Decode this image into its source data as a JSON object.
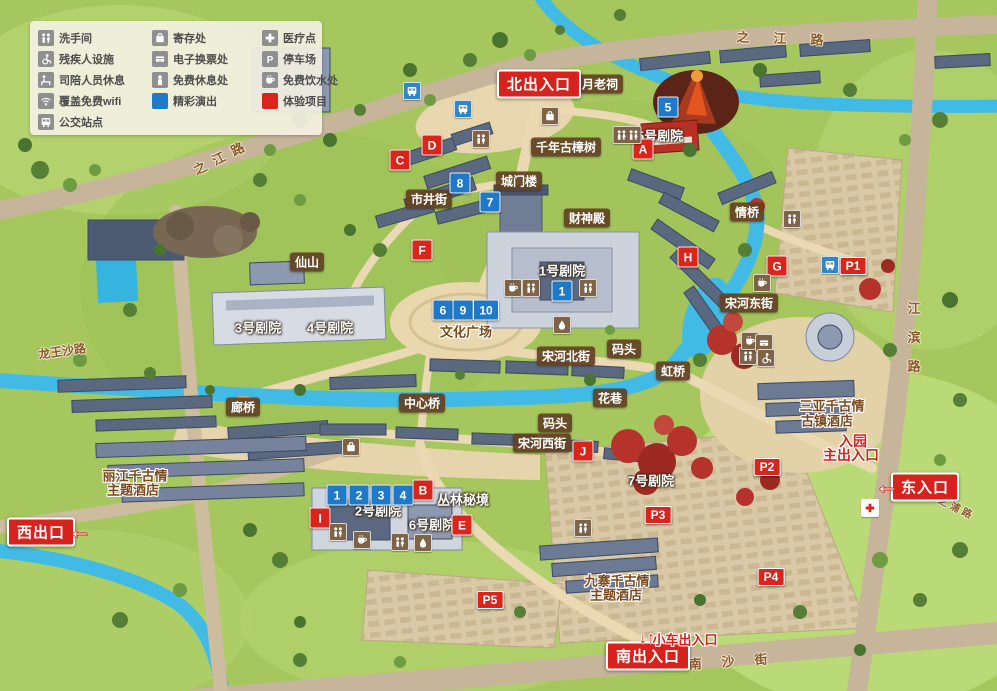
{
  "legend": {
    "col1": [
      {
        "icon": "restroom-icon",
        "label": "洗手间"
      },
      {
        "icon": "wheelchair-icon",
        "label": "残疾人设施"
      },
      {
        "icon": "staff-rest-icon",
        "label": "司陪人员休息"
      },
      {
        "icon": "wifi-icon",
        "label": "覆盖免费wifi"
      },
      {
        "icon": "bus-icon",
        "label": "公交站点"
      }
    ],
    "col2": [
      {
        "icon": "locker-icon",
        "label": "寄存处"
      },
      {
        "icon": "eticket-icon",
        "label": "电子换票处"
      },
      {
        "icon": "rest-icon",
        "label": "免费休息处"
      },
      {
        "icon": "show-square",
        "label": "精彩演出"
      }
    ],
    "col3": [
      {
        "icon": "medical-icon",
        "label": "医疗点"
      },
      {
        "icon": "parking-icon",
        "label": "停车场"
      },
      {
        "icon": "water-icon",
        "label": "免费饮水处"
      },
      {
        "icon": "experience-square",
        "label": "体验项目"
      }
    ]
  },
  "colors": {
    "show_blue": "#1e79c8",
    "experience_red": "#da251c",
    "river": "#41bbe5",
    "road": "#c6b59a"
  },
  "entrances": {
    "north": "北出入口",
    "south": "南出入口",
    "west": "西出口",
    "east": "东入口",
    "main_line1": "入园",
    "main_line2": "主出入口",
    "car": "小车出入口",
    "west_arrow": "←",
    "east_arrow": "←",
    "car_arrows": "↓↑"
  },
  "roads": {
    "zhijiang": "之江路",
    "longwangsha": "龙王沙路",
    "jiangbin": "江滨路",
    "nansha": "南沙街",
    "zhipu": "之浦路"
  },
  "places": {
    "yuelao": "月老祠",
    "camphor": "千年古樟树",
    "gate_tower": "城门楼",
    "market_street": "市井街",
    "caishen": "财神殿",
    "xianshan": "仙山",
    "song_east": "宋河东街",
    "song_north": "宋河北街",
    "song_west": "宋河西街",
    "dock": "码头",
    "qing_bridge": "情桥",
    "hong_bridge": "虹桥",
    "lang_bridge": "廊桥",
    "center_bridge": "中心桥",
    "flower_lane": "花巷",
    "jungle": "丛林秘境",
    "culture_square": "文化广场",
    "theater1": "1号剧院",
    "theater2": "2号剧院",
    "theater3": "3号剧院",
    "theater4": "4号剧院",
    "theater5": "5号剧院",
    "theater6": "6号剧院",
    "theater7": "7号剧院"
  },
  "hotels": {
    "lijiang_l1": "丽江千古情",
    "lijiang_l2": "主题酒店",
    "jiuzhai_l1": "九寨千古情",
    "jiuzhai_l2": "主题酒店",
    "sanya_l1": "三亚千古情",
    "sanya_l2": "古镇酒店"
  },
  "markers": {
    "n1": "1",
    "n2": "2",
    "n3": "3",
    "n4": "4",
    "n5": "5",
    "n6": "6",
    "n7": "7",
    "n8": "8",
    "n9": "9",
    "n10": "10",
    "A": "A",
    "B": "B",
    "C": "C",
    "D": "D",
    "E": "E",
    "F": "F",
    "G": "G",
    "H": "H",
    "I": "I",
    "J": "J",
    "P1": "P1",
    "P2": "P2",
    "P3": "P3",
    "P4": "P4",
    "P5": "P5"
  }
}
